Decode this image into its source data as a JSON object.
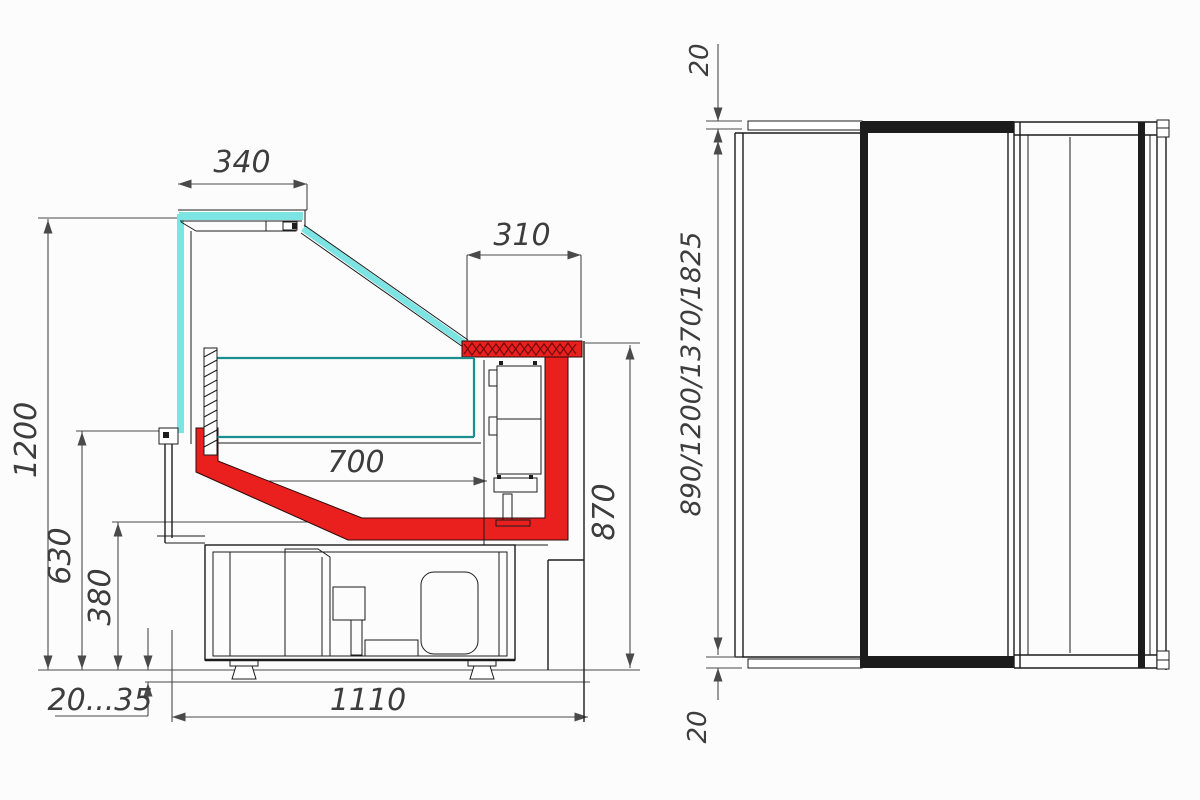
{
  "drawing_title": "refrigerated-display-case-dimension-drawing",
  "labels": {
    "d340": "340",
    "d310": "310",
    "d700": "700",
    "d1200": "1200",
    "d630": "630",
    "d380": "380",
    "d2035": "20...35",
    "d1110": "1110",
    "d870": "870",
    "d20top": "20",
    "dlengths": "890/1200/1370/1825",
    "d20bottom": "20"
  },
  "colors": {
    "background": "#fcfcfc",
    "line": "#1c1c1c",
    "dim_line": "#4a4a4a",
    "text": "#3d3d3d",
    "glass_cyan": "#7ce4e2",
    "glass_teal": "#1a8f8f",
    "accent_red": "#e9201e",
    "hatch_dark_red": "#7a0c0c"
  }
}
